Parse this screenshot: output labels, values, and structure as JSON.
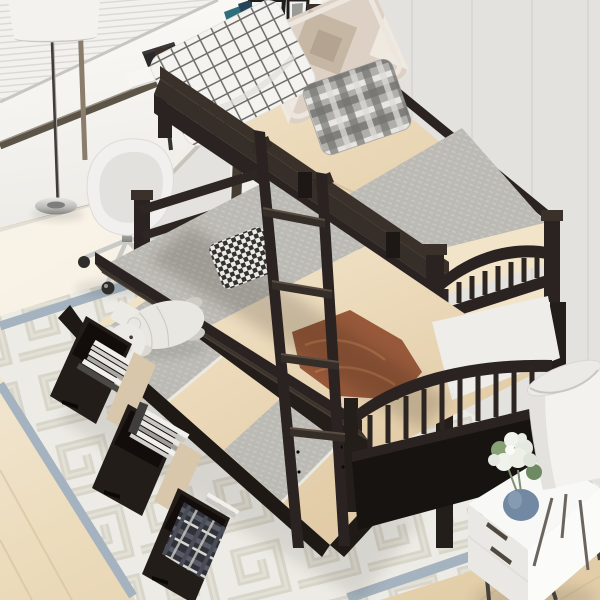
{
  "meta": {
    "domain": "natural-image",
    "subject": "Espresso twin-over-twin wood bunk bed with pull-out trundle and three open storage drawers, staged in a bright bedroom",
    "view": "high-angle product photo"
  },
  "palette": {
    "wall": "#e4e2df",
    "wallBright": "#efeeea",
    "wallSeam": "#d4d2cf",
    "blinds": "#f2f1ee",
    "glassTop": "#fbfaf7",
    "glassBottom": "#eeece8",
    "windowFrame": "#5d5448",
    "windowSill": "#948a7b",
    "floorBright": "#f6efe2",
    "floorWarm": "#e2cda8",
    "plank": "#d3bd97",
    "rug": "#edebe5",
    "rugPattern": "#cfccbe",
    "rugBorder": "#a4b3bf",
    "wood": "#2a2321",
    "woodMid": "#3a312b",
    "woodLight": "#4b3f37",
    "woodDark": "#171310",
    "mattress": "#ead7b9",
    "mattressLight": "#f2e4c9",
    "mattressSeam": "#cdb694",
    "blanketGray": "#bcbab4",
    "blanketGrayLight": "#cfcdc7",
    "blanketRust": "#97593a",
    "blanketRustLight": "#b37048",
    "sheetWhite": "#eeede9",
    "pillowWhite": "#f4f3f0",
    "pillowGridLine": "#5f5e5b",
    "pillowPatch": "#dcd1c4",
    "pillowPatchDark": "#c6b6a4",
    "pillowPatchDeep": "#b3a390",
    "pillowPlaidBase": "#b0afac",
    "houndstoothDark": "#34322f",
    "bear": "#e9e7e2",
    "bearShade": "#cfccc6",
    "bookLight": "#f1f0ed",
    "bookMid": "#c8c7c3",
    "bookDark": "#4b4945",
    "drawerGap": "#d8c7aa",
    "nightstand": "#f8f8f6",
    "nightstandShade": "#e9e8e5",
    "metalLeg": "#45423e",
    "lampShade": "#f3f2ef",
    "lampShadeShade": "#e0dfdb",
    "vase": "#7389a3",
    "flower": "#f0f2ec",
    "leaf": "#87a076",
    "chrome": "#c9c9c7",
    "chromeDark": "#8f8f8d",
    "chairShell": "#f1f0ee",
    "chairInner": "#e2e1de",
    "teal": "#2f6f7d",
    "navy": "#27435a",
    "plant": "#b9c257",
    "frame": "#1e1d1c",
    "photo": "#a5a5a3"
  },
  "scene": {
    "objects": [
      "bunk-bed",
      "top-bunk",
      "bottom-bunk",
      "trundle-bed",
      "storage-drawer-1",
      "storage-drawer-2",
      "storage-drawer-3",
      "ladder",
      "guard-rails",
      "windowpane-check-pillow",
      "patchwork-pillow",
      "plaid-pillow",
      "houndstooth-pillow",
      "gray-knit-blanket",
      "rust-throw-blanket",
      "teddy-bear-plush",
      "books-in-drawers",
      "plaid-throw-in-drawer",
      "greek-key-area-rug",
      "floor-lamp",
      "white-swivel-chair",
      "desk",
      "window-with-blinds",
      "picture-frames",
      "white-nightstand",
      "tripod-table-lamp",
      "flower-vase"
    ]
  }
}
